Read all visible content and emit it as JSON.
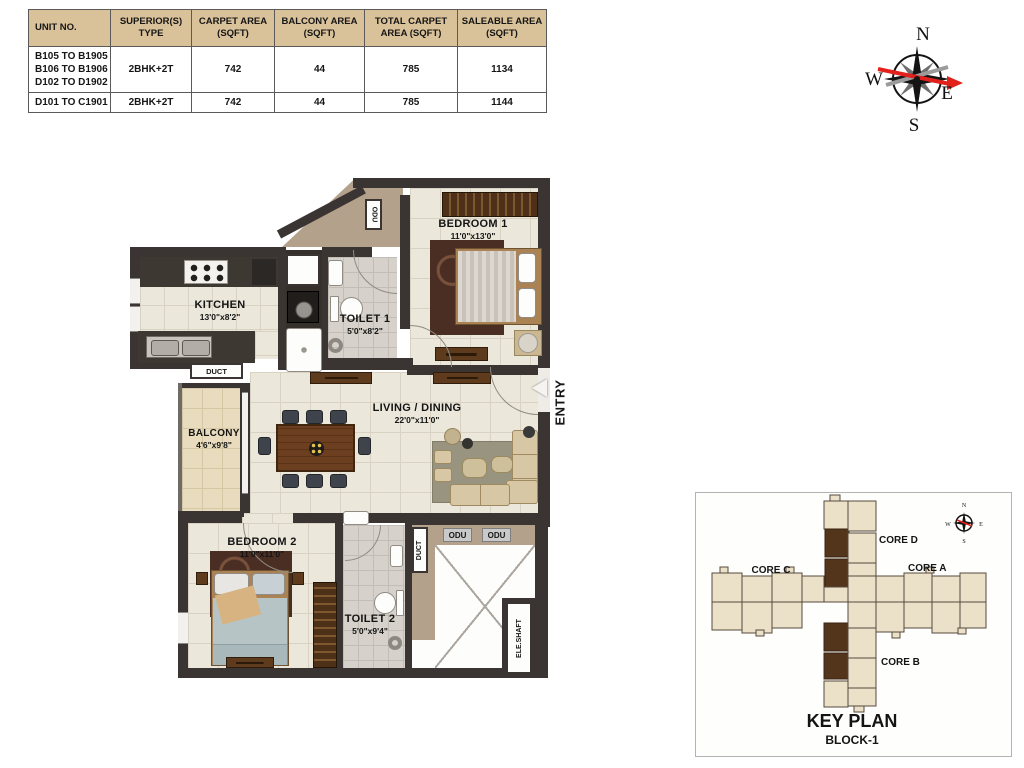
{
  "table": {
    "headers": [
      [
        "UNIT NO."
      ],
      [
        "SUPERIOR(S)",
        "TYPE"
      ],
      [
        "CARPET AREA",
        "(SQFT)"
      ],
      [
        "BALCONY AREA",
        "(SQFT)"
      ],
      [
        "TOTAL CARPET",
        "AREA (SQFT)"
      ],
      [
        "SALEABLE AREA",
        "(SQFT)"
      ]
    ],
    "rows": [
      {
        "unit_lines": [
          "B105 TO B1905",
          "B106 TO B1906",
          "D102 TO D1902"
        ],
        "type": "2BHK+2T",
        "carpet": "742",
        "balcony": "44",
        "total_carpet": "785",
        "saleable": "1134"
      },
      {
        "unit_lines": [
          "D101 TO C1901"
        ],
        "type": "2BHK+2T",
        "carpet": "742",
        "balcony": "44",
        "total_carpet": "785",
        "saleable": "1144"
      }
    ]
  },
  "compass": {
    "n": "N",
    "e": "E",
    "s": "S",
    "w": "W"
  },
  "floor_plan": {
    "rooms": {
      "bedroom1": {
        "name": "BEDROOM 1",
        "dim": "11'0\"x13'0\""
      },
      "kitchen": {
        "name": "KITCHEN",
        "dim": "13'0\"x8'2\""
      },
      "toilet1": {
        "name": "TOILET 1",
        "dim": "5'0\"x8'2\""
      },
      "living": {
        "name": "LIVING / DINING",
        "dim": "22'0\"x11'0\""
      },
      "balcony": {
        "name": "BALCONY",
        "dim": "4'6\"x9'8\""
      },
      "bedroom2": {
        "name": "BEDROOM 2",
        "dim": "11'0\"x11'0\""
      },
      "toilet2": {
        "name": "TOILET 2",
        "dim": "5'0\"x9'4\""
      }
    },
    "labels": {
      "entry": "ENTRY",
      "odu_top": "ODU",
      "duct_kitchen": "DUCT",
      "duct_lobby": "DUCT",
      "odu_1": "ODU",
      "odu_2": "ODU",
      "ele_shaft": "ELE.SHAFT"
    }
  },
  "key_plan": {
    "title": "KEY PLAN",
    "subtitle": "BLOCK-1",
    "cores": {
      "c": "CORE C",
      "d": "CORE D",
      "a": "CORE A",
      "b": "CORE B"
    },
    "compass": {
      "n": "N",
      "e": "E",
      "s": "S",
      "w": "W"
    }
  },
  "colors": {
    "header_tan": "#d9c199",
    "wall": "#3a3532",
    "tan_area": "#b3a18c",
    "floor_cream": "#ece7db",
    "keyplan_unit": "#eae1c8",
    "keyplan_highlight": "#53351c",
    "compass_red": "#e2211c"
  }
}
